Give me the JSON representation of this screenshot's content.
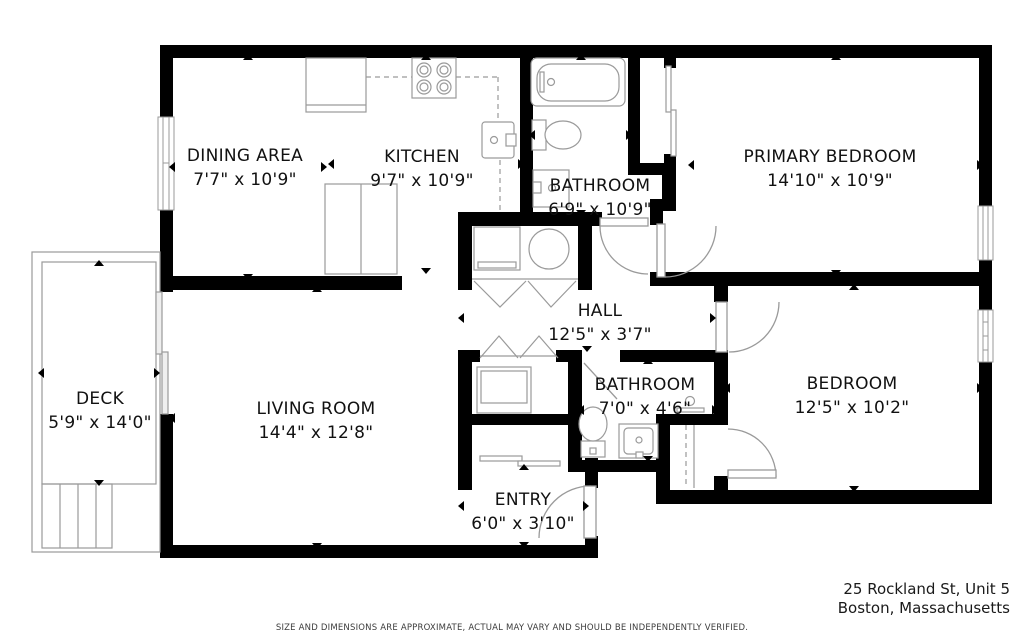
{
  "disclaimer": "SIZE AND DIMENSIONS ARE APPROXIMATE, ACTUAL MAY VARY AND SHOULD BE INDEPENDENTLY VERIFIED.",
  "address": {
    "line1": "25 Rockland St, Unit 5",
    "line2": "Boston, Massachusetts"
  },
  "colors": {
    "wall": "#000000",
    "fixture": "#9a9a9a",
    "text": "#111111"
  },
  "rooms": [
    {
      "id": "dining-area",
      "label": "DINING AREA",
      "dims": "7'7\" x 10'9\"",
      "cx": 245,
      "top": 144,
      "bbox": [
        173,
        58,
        150,
        218
      ]
    },
    {
      "id": "kitchen",
      "label": "KITCHEN",
      "dims": "9'7\" x 10'9\"",
      "cx": 422,
      "top": 145,
      "bbox": [
        332,
        58,
        188,
        212
      ]
    },
    {
      "id": "bathroom-1",
      "label": "BATHROOM",
      "dims": "6'9\" x 10'9\"",
      "cx": 600,
      "top": 174,
      "bbox": [
        533,
        58,
        95,
        154
      ]
    },
    {
      "id": "primary-bedroom",
      "label": "PRIMARY BEDROOM",
      "dims": "14'10\" x 10'9\"",
      "cx": 830,
      "top": 145,
      "bbox": [
        692,
        58,
        287,
        214
      ]
    },
    {
      "id": "hall",
      "label": "HALL",
      "dims": "12'5\" x 3'7\"",
      "cx": 600,
      "top": 299,
      "bbox": [
        462,
        288,
        250,
        60
      ]
    },
    {
      "id": "deck",
      "label": "DECK",
      "dims": "5'9\" x 14'0\"",
      "cx": 100,
      "top": 387,
      "bbox": [
        42,
        264,
        114,
        218
      ]
    },
    {
      "id": "living-room",
      "label": "LIVING ROOM",
      "dims": "14'4\" x 12'8\"",
      "cx": 316,
      "top": 397,
      "bbox": [
        173,
        290,
        287,
        255
      ]
    },
    {
      "id": "bathroom-2",
      "label": "BATHROOM",
      "dims": "7'0\" x 4'6\"",
      "cx": 645,
      "top": 373,
      "bbox": [
        582,
        362,
        132,
        96
      ]
    },
    {
      "id": "bedroom",
      "label": "BEDROOM",
      "dims": "12'5\" x 10'2\"",
      "cx": 852,
      "top": 372,
      "bbox": [
        728,
        288,
        251,
        200
      ]
    },
    {
      "id": "entry",
      "label": "ENTRY",
      "dims": "6'0\" x 3'10\"",
      "cx": 523,
      "top": 488,
      "bbox": [
        462,
        468,
        123,
        76
      ]
    }
  ],
  "fixtures": [
    "four-burner-stove",
    "kitchen-counter",
    "kitchen-sink",
    "refrigerator",
    "bathtub",
    "toilet",
    "vanity-sink",
    "washer",
    "dryer",
    "bifold-doors",
    "sliding-closet-doors",
    "shower-stall",
    "shower-head",
    "deck-stairs",
    "sliding-glass-door",
    "window",
    "hinged-door"
  ]
}
